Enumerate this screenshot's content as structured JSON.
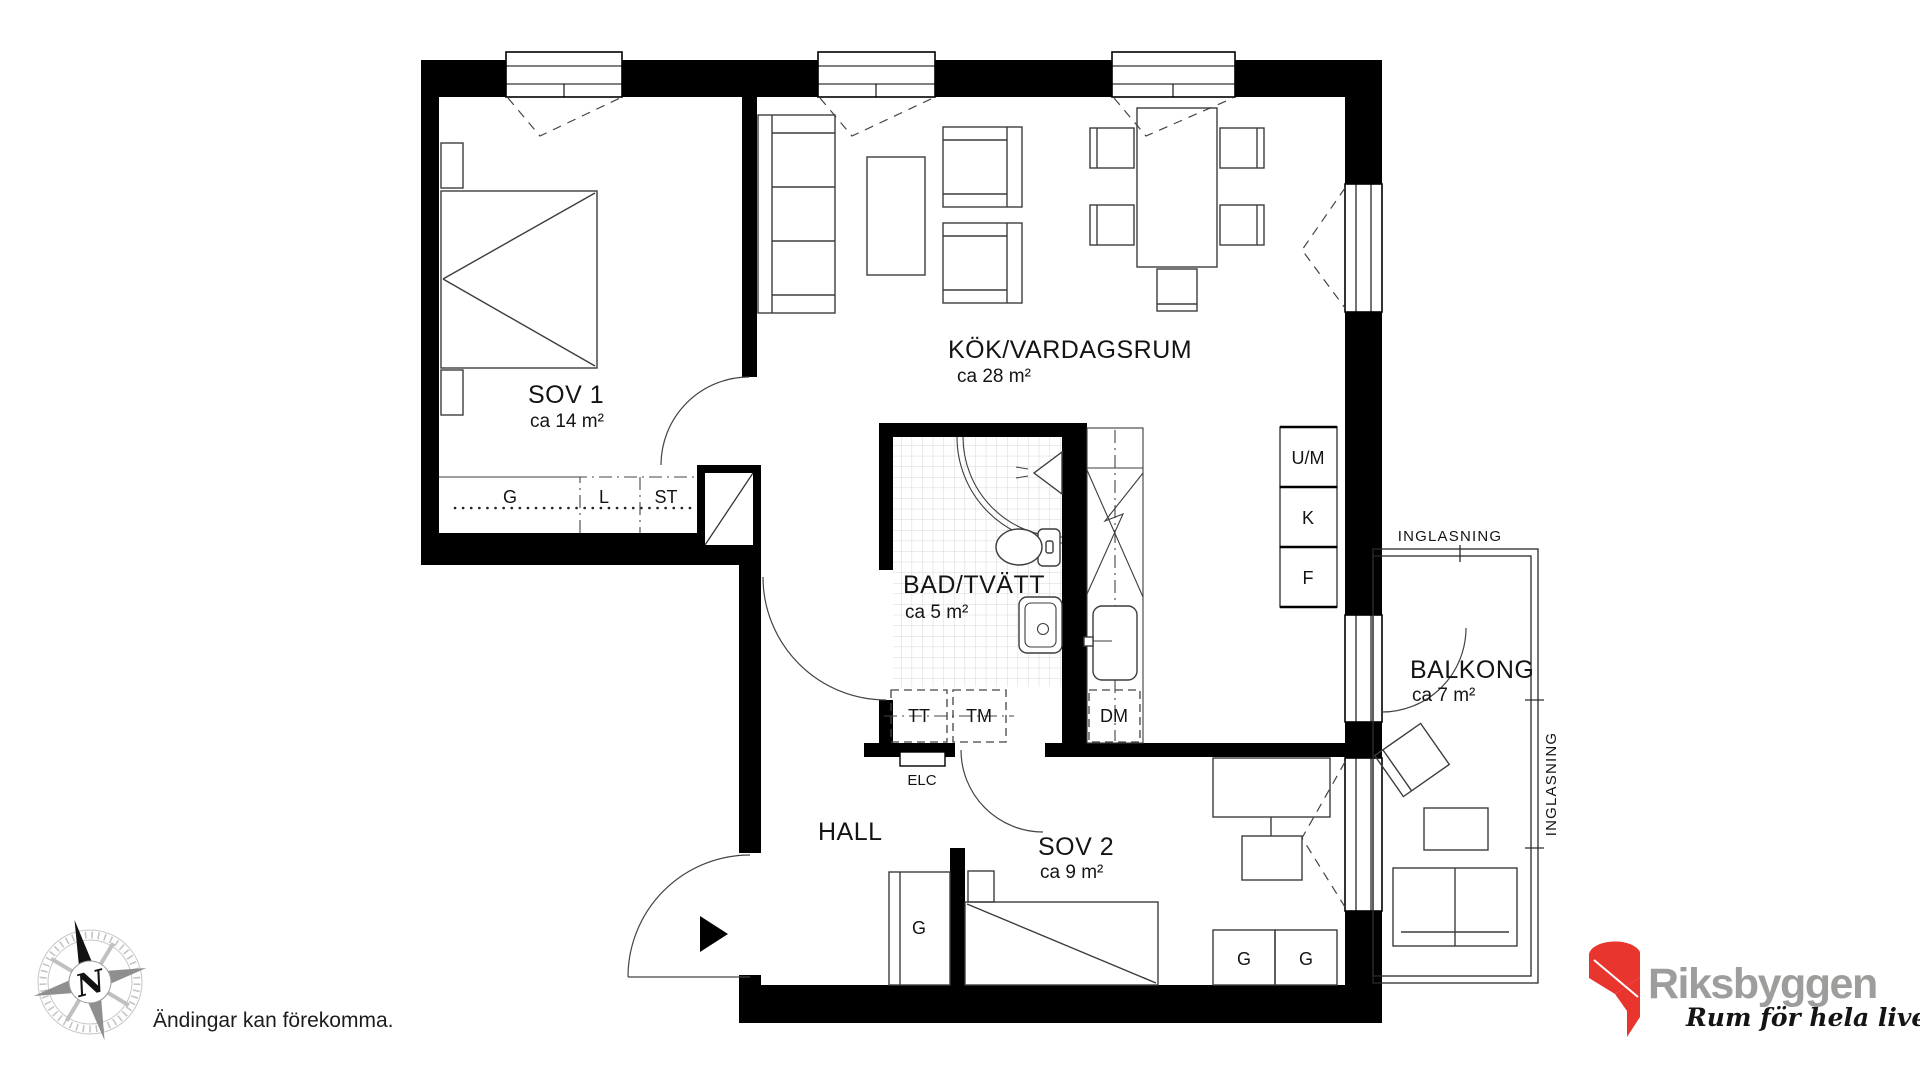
{
  "document": {
    "disclaimer": "Ändingar kan förekomma.",
    "compass_letter": "N"
  },
  "branding": {
    "company": "Riksbyggen",
    "tagline": "Rum för hela livet",
    "brand_red": "#e8352e",
    "brand_gray": "#9d9d9c"
  },
  "rooms": {
    "sov1": {
      "name": "SOV 1",
      "area": "ca 14 m²"
    },
    "kok": {
      "name": "KÖK/VARDAGSRUM",
      "area": "ca 28 m²"
    },
    "bad": {
      "name": "BAD/TVÄTT",
      "area": "ca 5 m²"
    },
    "hall": {
      "name": "HALL"
    },
    "sov2": {
      "name": "SOV 2",
      "area": "ca 9 m²"
    },
    "balkong": {
      "name": "BALKONG",
      "area": "ca 7 m²"
    }
  },
  "fixtures": {
    "wardrobe_sov1": "G",
    "linen_closet": "L",
    "cleaning_closet": "ST",
    "oven_micro": "U/M",
    "fridge": "K",
    "freezer": "F",
    "dryer": "TT",
    "washer": "TM",
    "dishwasher": "DM",
    "electrical_cabinet": "ELC",
    "wardrobe_hall": "G",
    "wardrobe_sov2_left": "G",
    "wardrobe_sov2_right": "G"
  },
  "annotations": {
    "glazing_top": "INGLASNING",
    "glazing_right": "INGLASNING"
  }
}
